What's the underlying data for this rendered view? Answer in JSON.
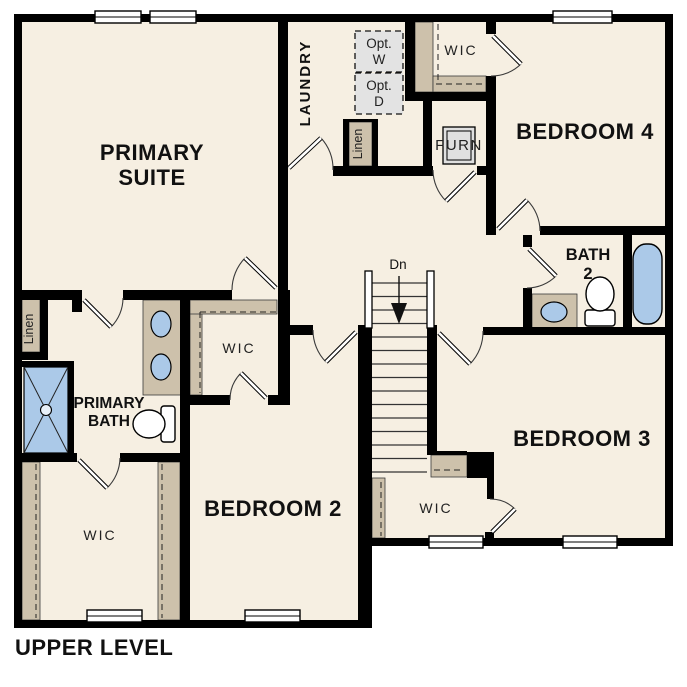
{
  "plan": {
    "title": "UPPER LEVEL",
    "rooms": {
      "primary_suite": {
        "line1": "PRIMARY",
        "line2": "SUITE"
      },
      "laundry": {
        "label": "LAUNDRY"
      },
      "bedroom4": {
        "label": "BEDROOM 4"
      },
      "bedroom3": {
        "label": "BEDROOM 3"
      },
      "bedroom2": {
        "label": "BEDROOM 2"
      },
      "bath2": {
        "line1": "BATH",
        "line2": "2"
      },
      "primary_bath": {
        "line1": "PRIMARY",
        "line2": "BATH"
      },
      "wic_top": {
        "label": "WIC"
      },
      "wic_middle": {
        "label": "WIC"
      },
      "wic_bottom_left": {
        "label": "WIC"
      },
      "wic_bottom_middle": {
        "label": "WIC"
      },
      "furnace": {
        "label": "FURN"
      },
      "linen_left": {
        "label": "Linen"
      },
      "linen_top": {
        "label": "Linen"
      },
      "optional_washer": {
        "line1": "Opt.",
        "line2": "W"
      },
      "optional_dryer": {
        "line1": "Opt.",
        "line2": "D"
      },
      "stairs": {
        "label": "Dn"
      }
    },
    "colors": {
      "floor": "#f6efe2",
      "casework_tan": "#cdc1ab",
      "fixture_blue": "#abc9e8",
      "optional_gray": "#e3e3e3",
      "wall": "#000000",
      "background": "#ffffff"
    }
  }
}
